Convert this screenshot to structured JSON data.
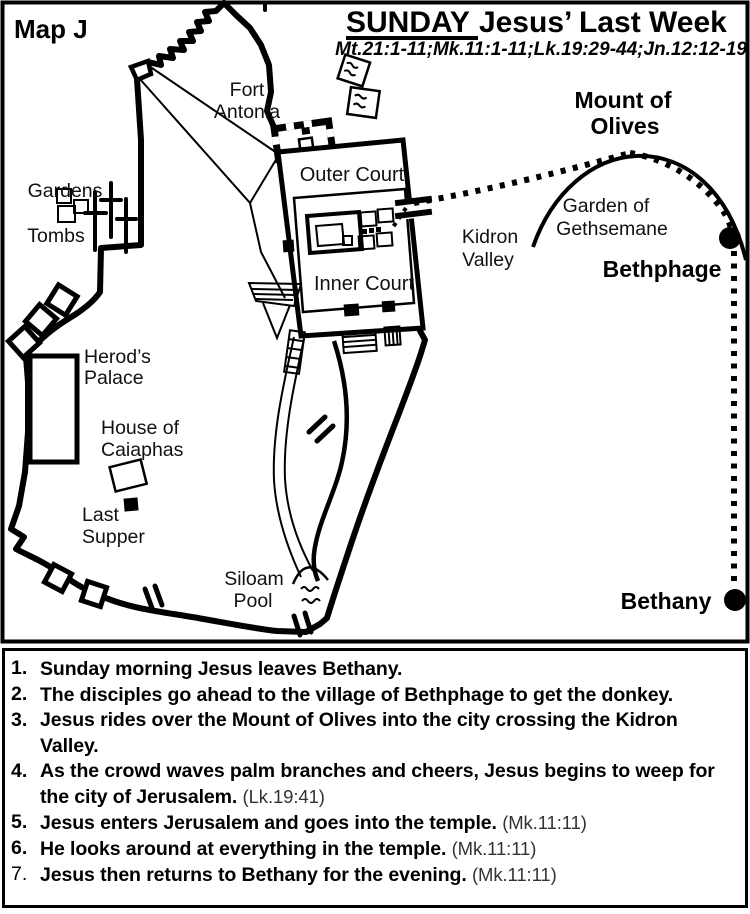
{
  "header": {
    "map_label": "Map J",
    "title_day": "SUNDAY",
    "title_rest": "Jesus’ Last Week",
    "scripture_refs": "Mt.21:1-11;Mk.11:1-11;Lk.19:29-44;Jn.12:12-19"
  },
  "places": {
    "fort_antonia": {
      "line1": "Fort",
      "line2": "Antonia"
    },
    "outer_court": {
      "label": "Outer Court"
    },
    "inner_court": {
      "label": "Inner Court"
    },
    "gardens": {
      "label": "Gardens"
    },
    "tombs": {
      "label": "Tombs"
    },
    "herods_palace": {
      "line1": "Herod’s",
      "line2": "Palace"
    },
    "house_of_caiaphas": {
      "line1": "House of",
      "line2": "Caiaphas"
    },
    "last_supper": {
      "line1": "Last",
      "line2": "Supper"
    },
    "siloam_pool": {
      "line1": "Siloam",
      "line2": "Pool"
    },
    "kidron_valley": {
      "line1": "Kidron",
      "line2": "Valley"
    },
    "garden_of_gethsemane": {
      "line1": "Garden of",
      "line2": "Gethsemane"
    },
    "mount_of_olives": {
      "line1": "Mount of",
      "line2": "Olives"
    },
    "bethphage": {
      "label": "Bethphage"
    },
    "bethany": {
      "label": "Bethany"
    }
  },
  "events": [
    {
      "num": "1.",
      "text": "Sunday morning Jesus leaves Bethany.",
      "ref": ""
    },
    {
      "num": "2.",
      "text": "The disciples go ahead to the village of Bethphage to get the donkey.",
      "ref": ""
    },
    {
      "num": "3.",
      "text": "Jesus rides over the Mount of Olives into the city crossing the Kidron Valley.",
      "ref": ""
    },
    {
      "num": "4.",
      "text": "As the crowd waves palm branches and cheers, Jesus begins to weep for the city of Jerusalem.",
      "ref": "(Lk.19:41)"
    },
    {
      "num": "5.",
      "text": "Jesus enters Jerusalem and goes into the temple.",
      "ref": "(Mk.11:11)"
    },
    {
      "num": "6.",
      "text": "He looks around at everything in the temple.",
      "ref": "(Mk.11:11)"
    },
    {
      "num": "7.",
      "text": "Jesus then returns to Bethany for the evening.",
      "ref": "(Mk.11:11)"
    }
  ],
  "colors": {
    "ink": "#000000",
    "paper": "#ffffff",
    "ref_text": "#333333"
  }
}
